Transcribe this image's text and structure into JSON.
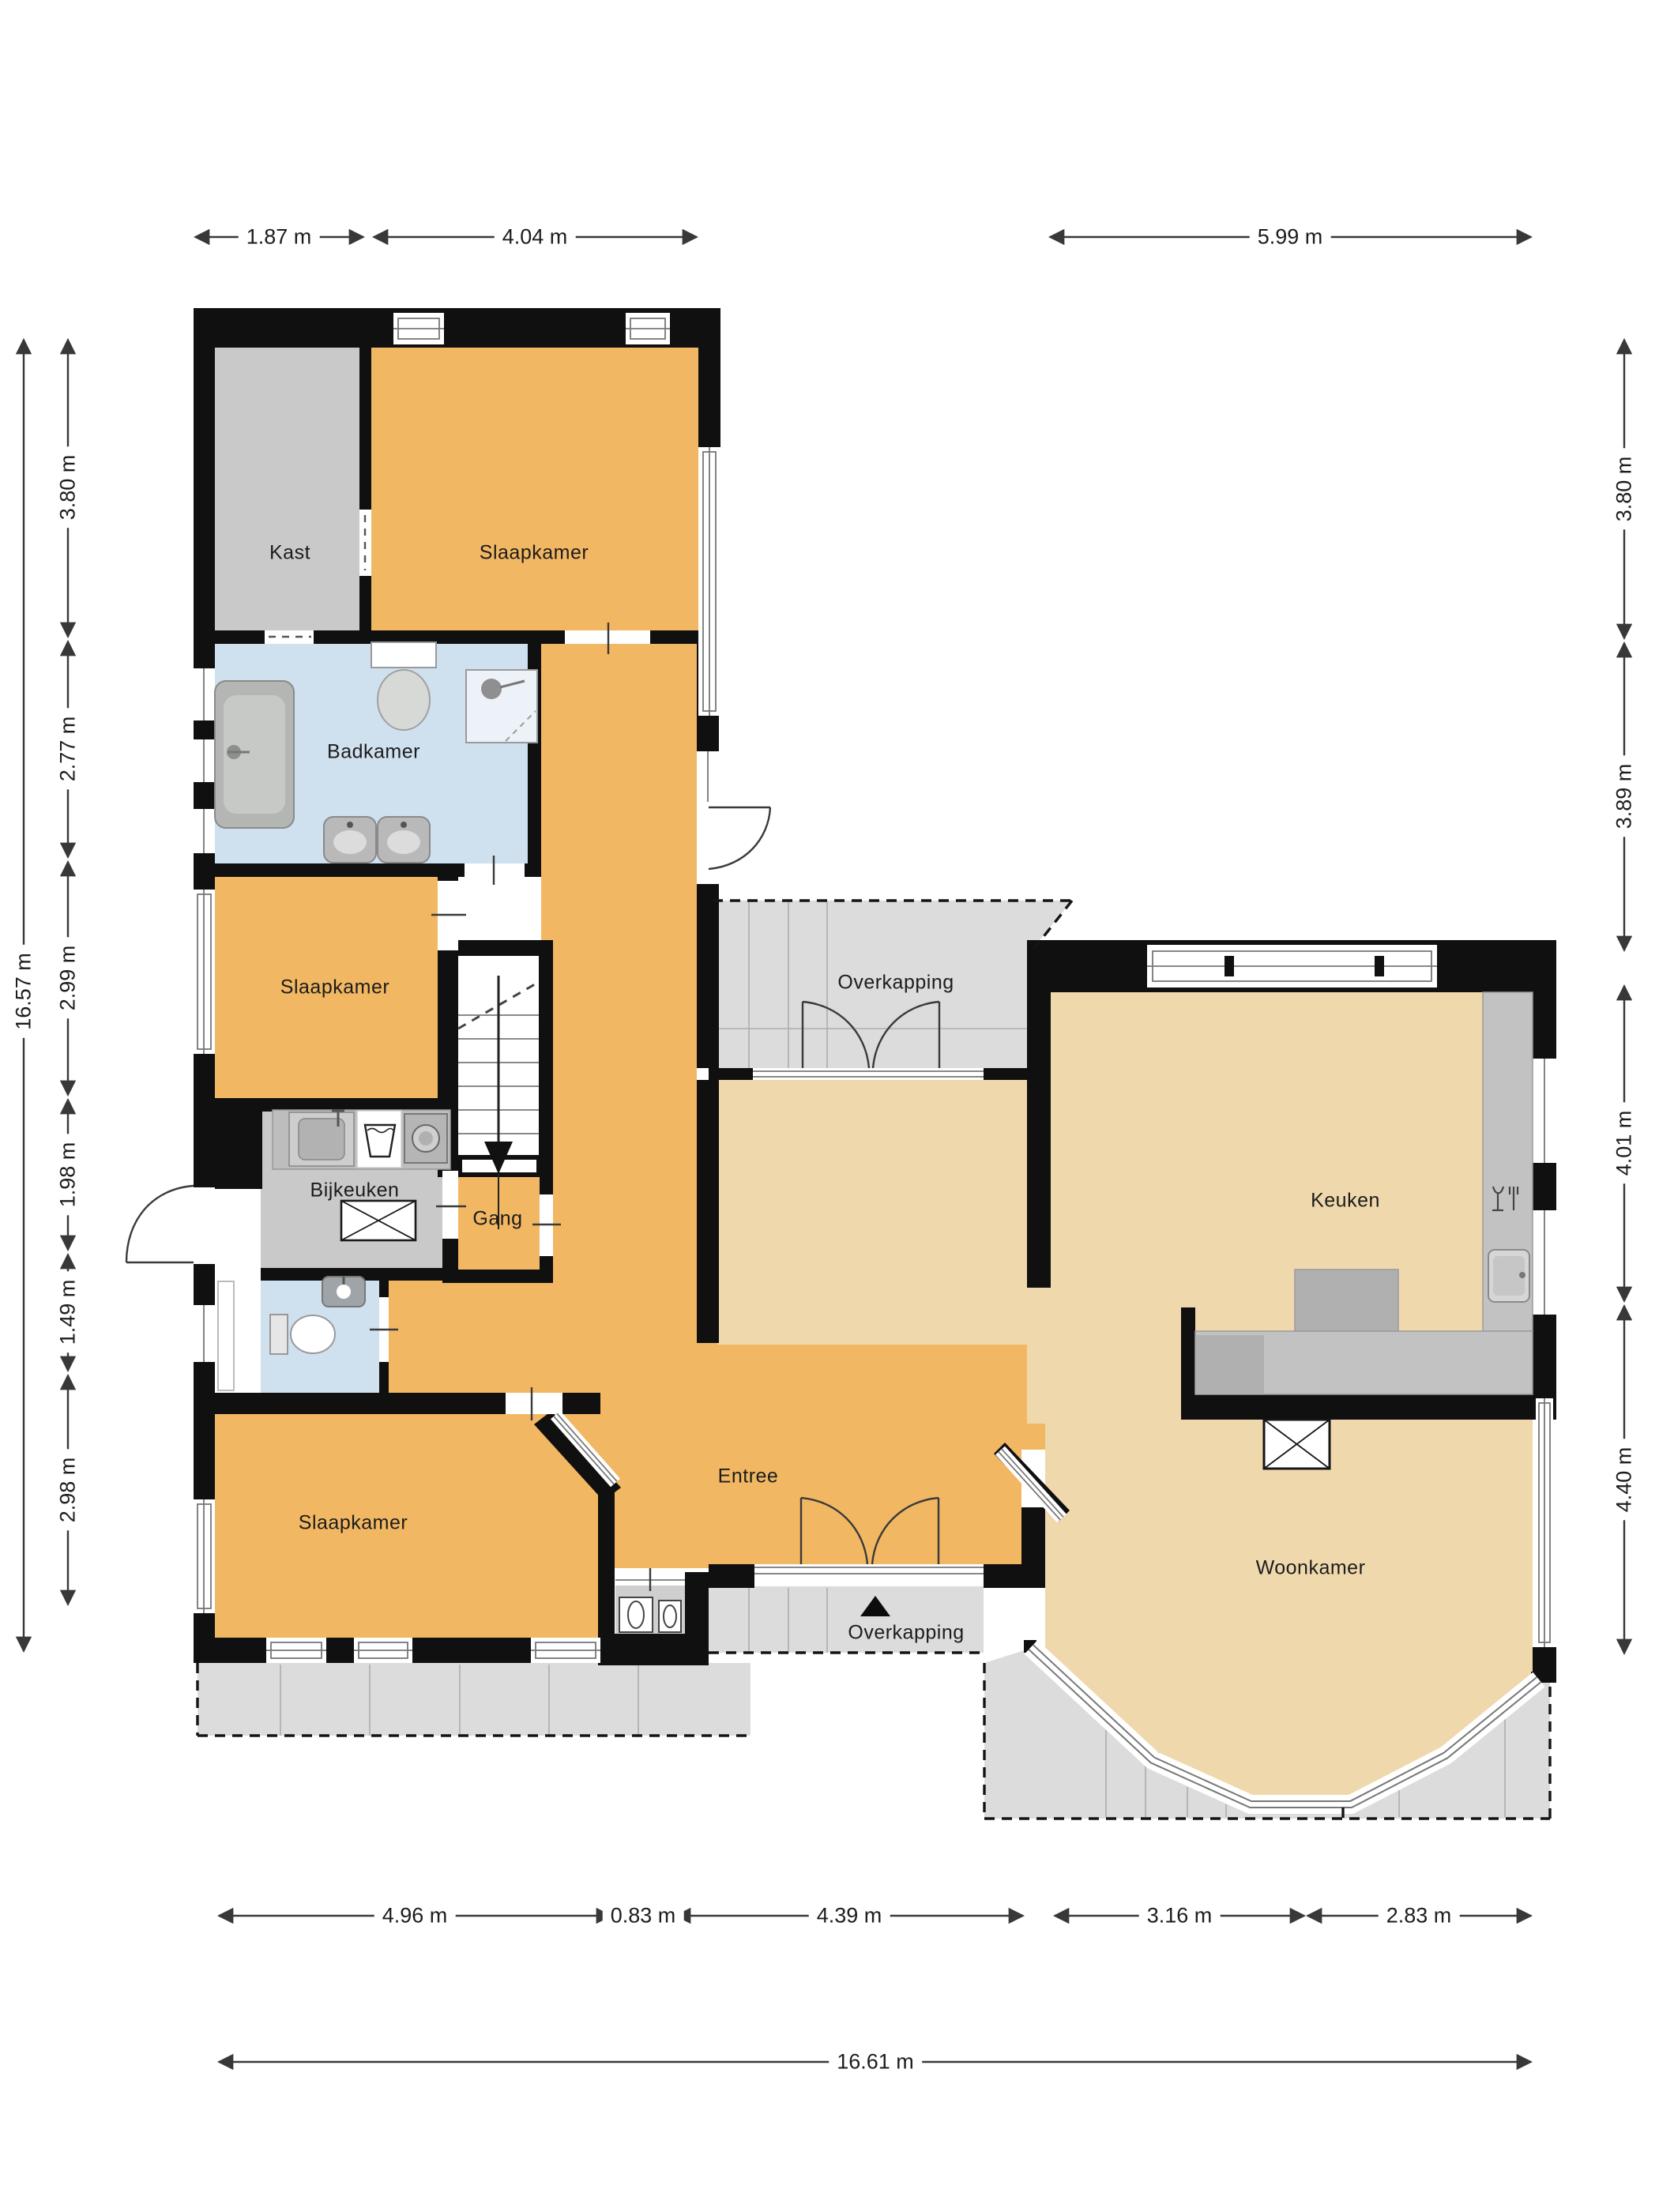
{
  "plan": {
    "type": "floor_plan",
    "rooms": {
      "kast": "Kast",
      "slaapkamer_top": "Slaapkamer",
      "badkamer": "Badkamer",
      "slaapkamer_mid": "Slaapkamer",
      "bijkeuken": "Bijkeuken",
      "gang": "Gang",
      "slaapkamer_bottom": "Slaapkamer",
      "entree": "Entree",
      "overkapping_top": "Overkapping",
      "keuken": "Keuken",
      "woonkamer": "Woonkamer",
      "overkapping_bottom": "Overkapping"
    },
    "dimensions": {
      "top": [
        "1.87 m",
        "4.04 m",
        "5.99 m"
      ],
      "left": [
        "3.80 m",
        "2.77 m",
        "2.99 m",
        "1.98 m",
        "1.49 m",
        "2.98 m"
      ],
      "left_total": "16.57 m",
      "right": [
        "3.80 m",
        "3.89 m",
        "4.01 m",
        "4.40 m"
      ],
      "bottom": [
        "4.96 m",
        "0.83 m",
        "4.39 m",
        "3.16 m",
        "2.83 m"
      ],
      "bottom_total": "16.61 m"
    },
    "icons": {
      "entrance_marker": "black triangle (north/entrance arrow)",
      "stairs_arrow": "down arrow"
    },
    "colors": {
      "wall": "#101010",
      "floor_orange": "#f2b763",
      "floor_tan": "#f0d8ad",
      "room_grey": "#c9c9c9",
      "bathroom_blue": "#cfe0ee",
      "patio_grey": "#dcdcdc",
      "dimension_text": "#1c1c1c"
    }
  }
}
